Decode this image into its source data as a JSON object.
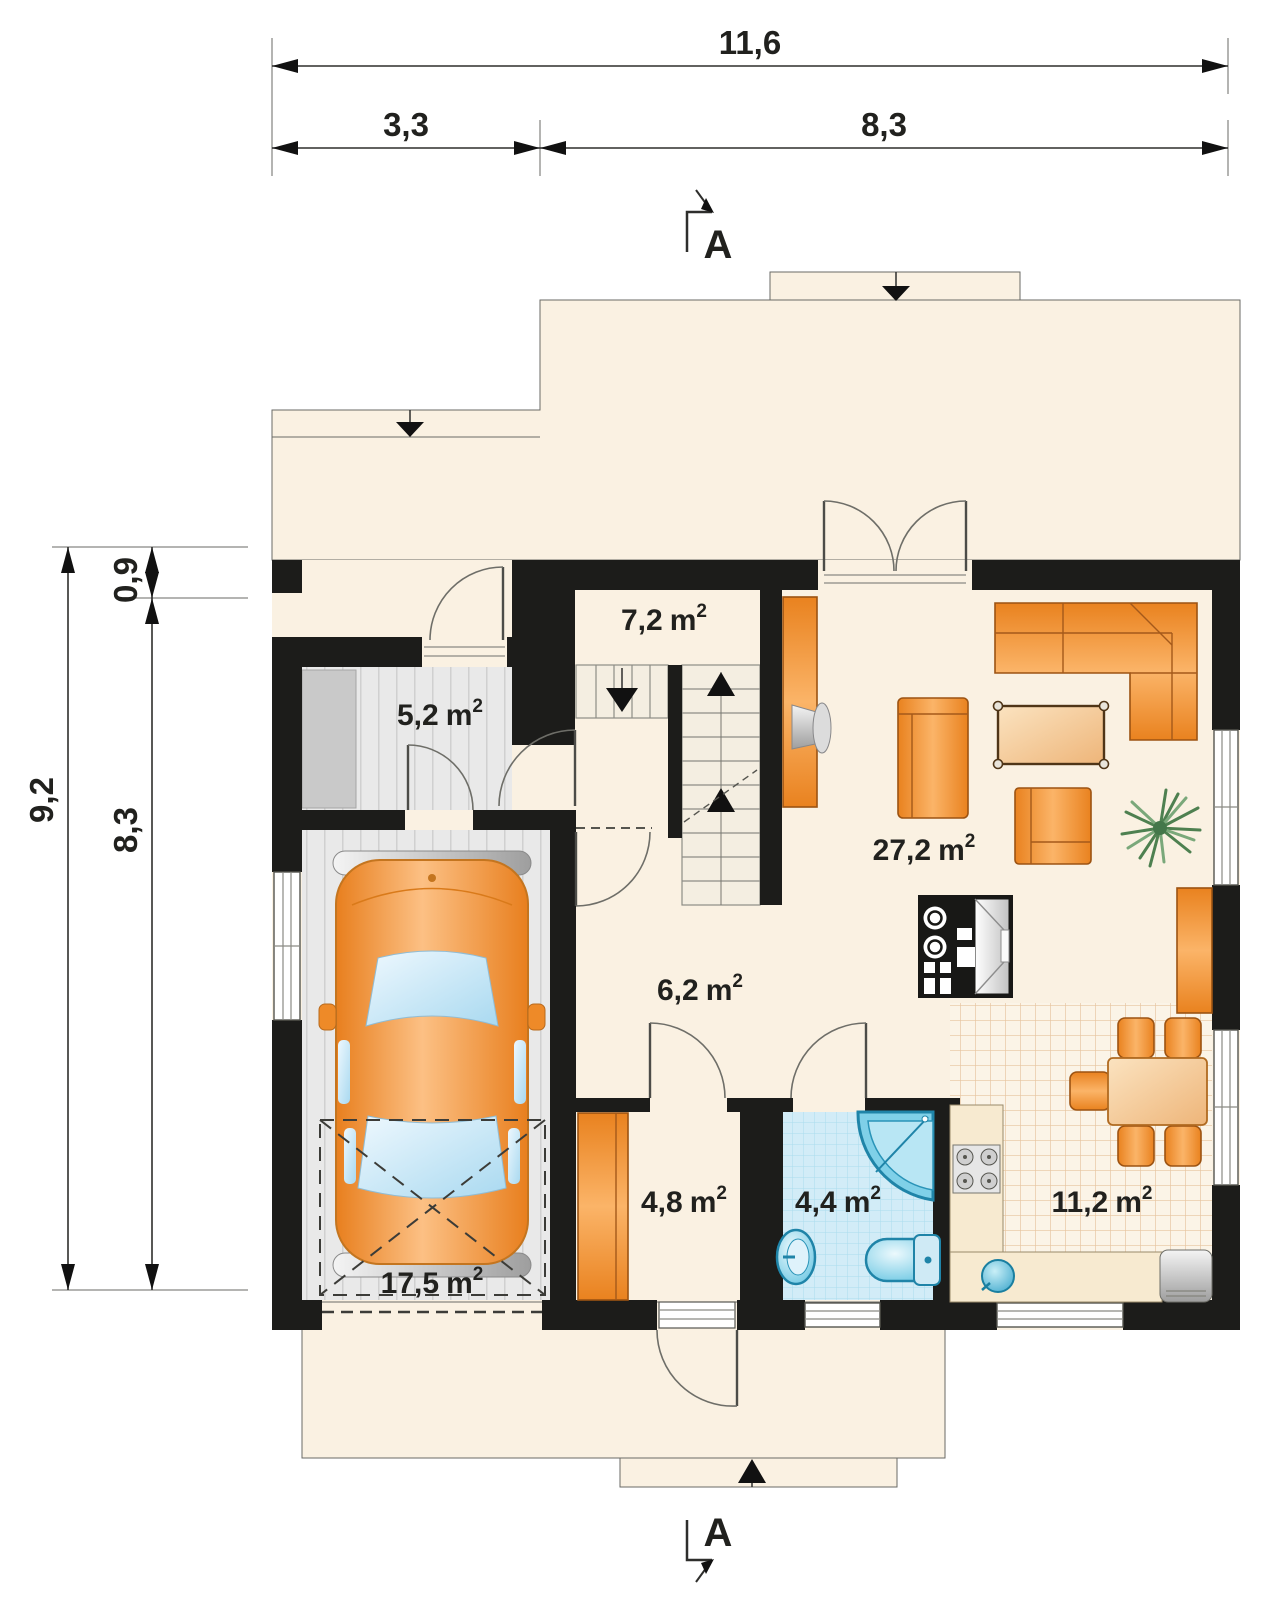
{
  "unit": {
    "label": "m",
    "sup": "2"
  },
  "dimensions": {
    "top": {
      "total": "11,6",
      "segment_left": "3,3",
      "segment_right": "8,3"
    },
    "left": {
      "total": "9,2",
      "segment_top": "0,9",
      "segment_bottom": "8,3"
    }
  },
  "section": {
    "label": "A"
  },
  "rooms": [
    {
      "id": "vestibule",
      "area": "5,2"
    },
    {
      "id": "staircase-hall",
      "area": "7,2"
    },
    {
      "id": "living-room",
      "area": "27,2"
    },
    {
      "id": "hall",
      "area": "6,2"
    },
    {
      "id": "garage",
      "area": "17,5"
    },
    {
      "id": "pantry",
      "area": "4,8"
    },
    {
      "id": "bathroom",
      "area": "4,4"
    },
    {
      "id": "kitchen-dining",
      "area": "11,2"
    }
  ],
  "colors": {
    "floor_cream": "#faf1e2",
    "wall_black": "#1c1c1a",
    "garage_floor_gray": "#e9e9e9",
    "furniture_orange": "#f09a42",
    "table_tan": "#f2cfa0",
    "bathroom_tile_blue": "#d2ecf7",
    "fixture_blue": "#49b8da",
    "kitchen_tile_line": "#e6c49e",
    "counter_cream": "#f7ead0",
    "glass_blue": "#cfe9f8",
    "metal_gray": "#b9b9b9"
  }
}
